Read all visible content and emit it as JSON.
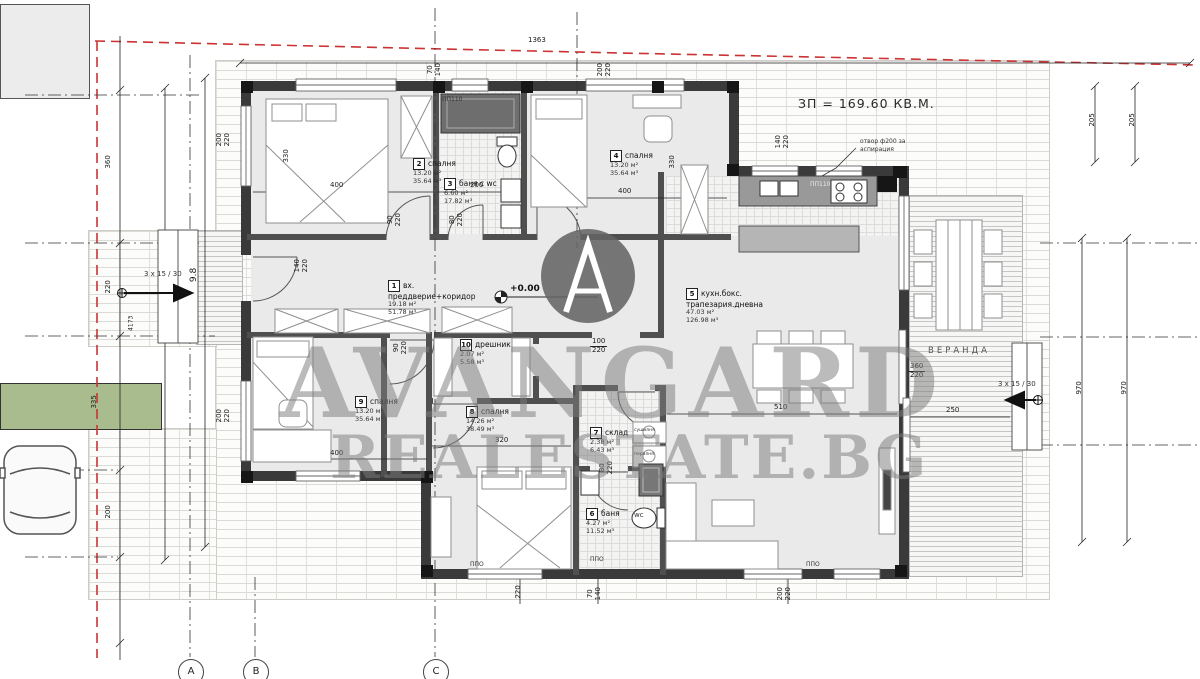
{
  "colors": {
    "boundary_red": "#cc3333",
    "watermark_gray": "#8a8a8a",
    "path_green": "#a9bc8e",
    "wall_dark": "#3a3a3a"
  },
  "header": {
    "built_area": "ЗП = 169.60 КВ.М."
  },
  "watermark": {
    "line1": "AVANGARD",
    "line2": "REALESTATE.BG"
  },
  "rooms": [
    {
      "num": "1",
      "name1": "вх.",
      "name2": "преддверие+коридор",
      "area": "19.18 м²",
      "volume": "51.78 м³"
    },
    {
      "num": "2",
      "name1": "спалня",
      "name2": "",
      "area": "13.20 м²",
      "volume": "35.64 м³"
    },
    {
      "num": "3",
      "name1": "баня с wc",
      "name2": "",
      "area": "6.60 м²",
      "volume": "17.82 м³"
    },
    {
      "num": "4",
      "name1": "спалня",
      "name2": "",
      "area": "13.20 м²",
      "volume": "35.64 м³"
    },
    {
      "num": "5",
      "name1": "кухн.бокс.",
      "name2": "трапезария.дневна",
      "area": "47.03 м²",
      "volume": "126.98 м³"
    },
    {
      "num": "6",
      "name1": "баня",
      "name2": "",
      "area": "4.27 м²",
      "volume": "11.52 м³"
    },
    {
      "num": "7",
      "name1": "склад",
      "name2": "",
      "area": "2.38 м²",
      "volume": "6.43 м³"
    },
    {
      "num": "8",
      "name1": "спалня",
      "name2": "",
      "area": "14.26 м²",
      "volume": "38.49 м³"
    },
    {
      "num": "9",
      "name1": "спалня",
      "name2": "",
      "area": "13.20 м²",
      "volume": "35.64 м³"
    },
    {
      "num": "10",
      "name1": "дрешник",
      "name2": "",
      "area": "2.07 м²",
      "volume": "5.58 м³"
    }
  ],
  "annotations": {
    "veranda": "ВЕРАНДА",
    "level": "+0.00",
    "vent1": "отвор ф200 за",
    "vent2": "аспирация",
    "stairs_left": "3 x 15 / 30",
    "stairs_right": "3 x 15 / 30",
    "pp110": "ПП110",
    "ppo": "ППО",
    "wc": "wc",
    "washer": "пералня",
    "dryer": "сушилня"
  },
  "grid_bubbles": [
    "A",
    "B",
    "C"
  ],
  "dims": {
    "top_total": "1363",
    "w_bath": {
      "a": "70",
      "b": "140"
    },
    "w_bed4": {
      "a": "200",
      "b": "220"
    },
    "w_kitchen": {
      "a": "140",
      "b": "220"
    },
    "w_left_top": {
      "a": "200",
      "b": "220"
    },
    "w_left_bot": {
      "a": "200",
      "b": "220"
    },
    "d_entry": {
      "a": "140",
      "b": "220"
    },
    "d_hall1": {
      "a": "90",
      "b": "220"
    },
    "d_hall2": {
      "a": "80",
      "b": "220"
    },
    "d_bed9": {
      "a": "90",
      "b": "220"
    },
    "d_bath6": {
      "a": "80",
      "b": "220"
    },
    "o_living": {
      "a": "100",
      "b": "220"
    },
    "d_veranda": {
      "a": "360",
      "b": "220"
    },
    "b_1": "220",
    "b_2": {
      "a": "70",
      "b": "140"
    },
    "b_3": {
      "a": "200",
      "b": "220"
    },
    "r_bed2_w": "400",
    "r_bed2_h": "330",
    "r_bath3_w": "200",
    "r_bed4_w": "400",
    "r_bed4_h": "330",
    "r_bed9_w": "400",
    "r_bed8_w": "320",
    "r_living_w": "510",
    "r_veranda_w": "250",
    "l_360": "360",
    "l_220": "220",
    "l_335": "335",
    "l_200": "200",
    "l_4173": "4173",
    "l_98": "9.8",
    "rt_205a": "205",
    "rt_205b": "205",
    "rt_970a": "970",
    "rt_970b": "970"
  }
}
